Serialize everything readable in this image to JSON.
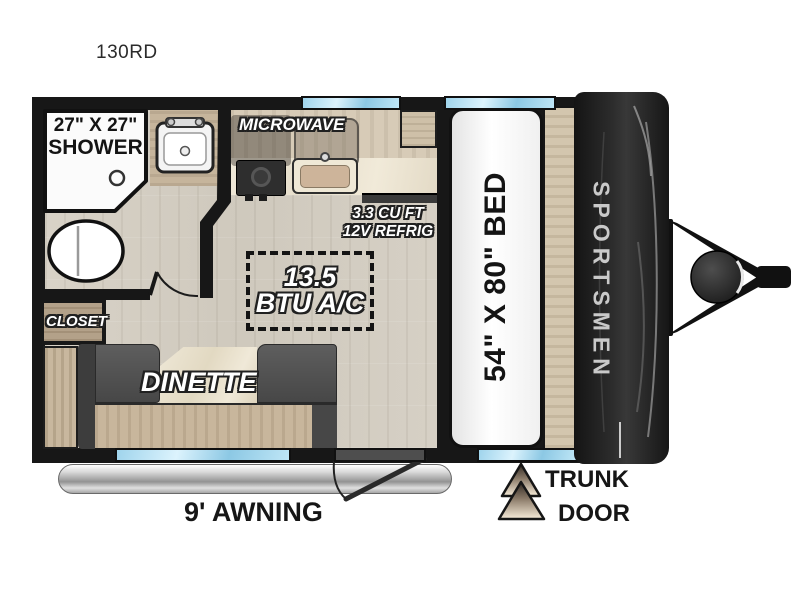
{
  "plan": {
    "model": "130RD",
    "brand": "SPORTSMEN"
  },
  "labels": {
    "shower1": "27\" X 27\"",
    "shower2": "SHOWER",
    "microwave": "MICROWAVE",
    "refrig1": "3.3 CU FT",
    "refrig2": "12V REFRIG",
    "ac1": "13.5",
    "ac2": "BTU A/C",
    "closet": "CLOSET",
    "dinette": "DINETTE",
    "bed": "54\" X 80\" BED",
    "awning": "9' AWNING",
    "trunk1": "TRUNK",
    "trunk2": "DOOR"
  },
  "colors": {
    "wall": "#171717",
    "floor": "#d3cdc2",
    "wood": "#c8b79e",
    "bench": "#555555",
    "window_blue": "#aee0f5",
    "marble": "#ece5d4",
    "cap_dark": "#1e1e1e",
    "awning_silver": "#bdbdbd"
  }
}
